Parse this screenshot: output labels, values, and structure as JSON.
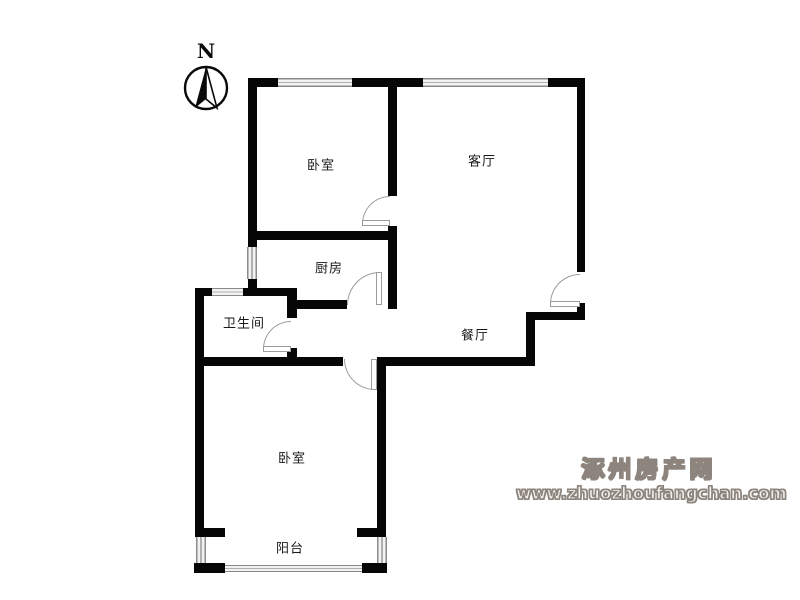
{
  "plan": {
    "compass_label": "N",
    "rooms": [
      {
        "id": "bedroom-top",
        "label": "卧室"
      },
      {
        "id": "living-room",
        "label": "客厅"
      },
      {
        "id": "kitchen",
        "label": "厨房"
      },
      {
        "id": "bathroom",
        "label": "卫生间"
      },
      {
        "id": "dining-room",
        "label": "餐厅"
      },
      {
        "id": "bedroom-bottom",
        "label": "卧室"
      },
      {
        "id": "balcony",
        "label": "阳台"
      }
    ],
    "colors": {
      "wall": "#060606",
      "window_line": "#8a8a8a",
      "door_line": "#9c9c9c",
      "room_label": "#1a1a1a",
      "watermark": "#8d857d"
    }
  },
  "watermark": {
    "site_name": "涿州房产网",
    "site_url": "www.zhuozhoufangchan.com"
  }
}
